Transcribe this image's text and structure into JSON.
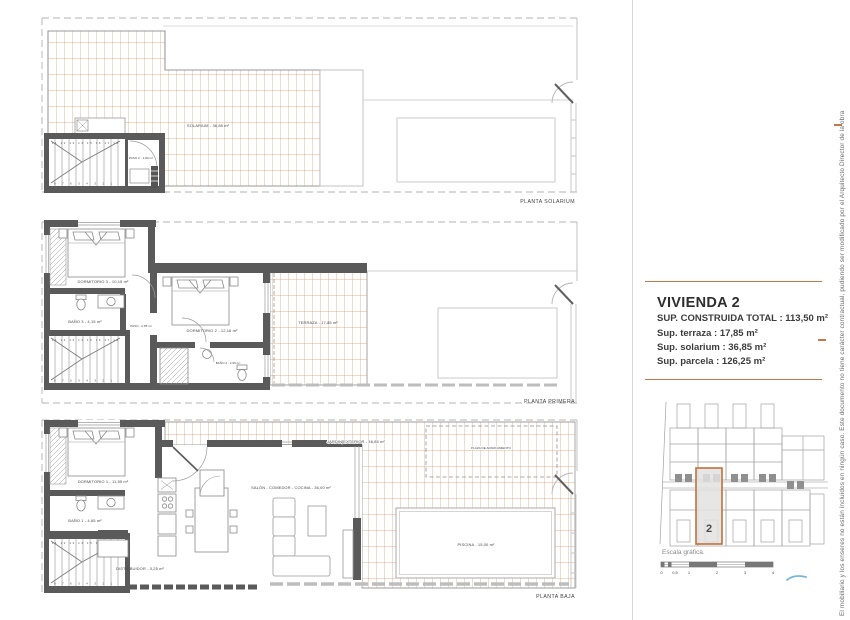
{
  "info_panel": {
    "title": "VIVIENDA 2",
    "line1": "SUP. CONSTRUIDA TOTAL : 113,50 m²",
    "line2": "Sup. terraza : 17,85 m²",
    "line3": "Sup. solarium : 36,85 m²",
    "line4": "Sup. parcela : 126,25 m²"
  },
  "plans": {
    "solarium": {
      "title": "PLANTA SOLARIUM",
      "solarium": "SOLARIUM - 36,85 m²",
      "paso": "PASO 2 - 1,80 m²"
    },
    "primera": {
      "title": "PLANTA PRIMERA",
      "dorm3": "DORMITORIO 3 - 10,15 m²",
      "bano3": "BAÑO 3 - 4,15 m²",
      "paso": "PASO - 2,85 m²",
      "dorm2": "DORMITORIO 2 - 12,16 m²",
      "bano2": "BAÑO 2 - 2,95 m²",
      "terraza": "TERRAZA - 17,85 m²"
    },
    "baja": {
      "title": "PLANTA BAJA",
      "dorm1": "DORMITORIO 1 - 11,55 m²",
      "bano1": "BAÑO 1 - 4,65 m²",
      "distribuidor": "DISTRIBUIDOR - 3,25 m²",
      "salon": "SALÓN - COMEDOR - COCINA - 36,00 m²",
      "jardin": "JARDIN EXTERIOR - 46,85 m²",
      "parking": "PLAZA DE APARCAMIENTO",
      "piscina": "PISCINA - 15,00 m²"
    }
  },
  "stairs": {
    "up": "11 12 13 14 15 16 17 18",
    "down": "8 7 6 5 4 3 2 1"
  },
  "site_plan": {
    "unit_number": "2"
  },
  "scale": {
    "label": "Escala gráfica.",
    "ticks": [
      "0",
      "0,5",
      "1",
      "2",
      "3",
      "4"
    ]
  },
  "disclaimer": "El mobiliario y los enseres no están incluidos en ningún caso. Este documento no tiene carácter contractual, pudiendo ser modificado por el Arquitecto Director de la obra",
  "colors": {
    "accent_orange": "#c4794a",
    "tile_line": "#cf9166",
    "wall_gray": "#5a5a5a",
    "reference_gray": "#c0c0c0",
    "blue_mark": "#76b7d9"
  }
}
